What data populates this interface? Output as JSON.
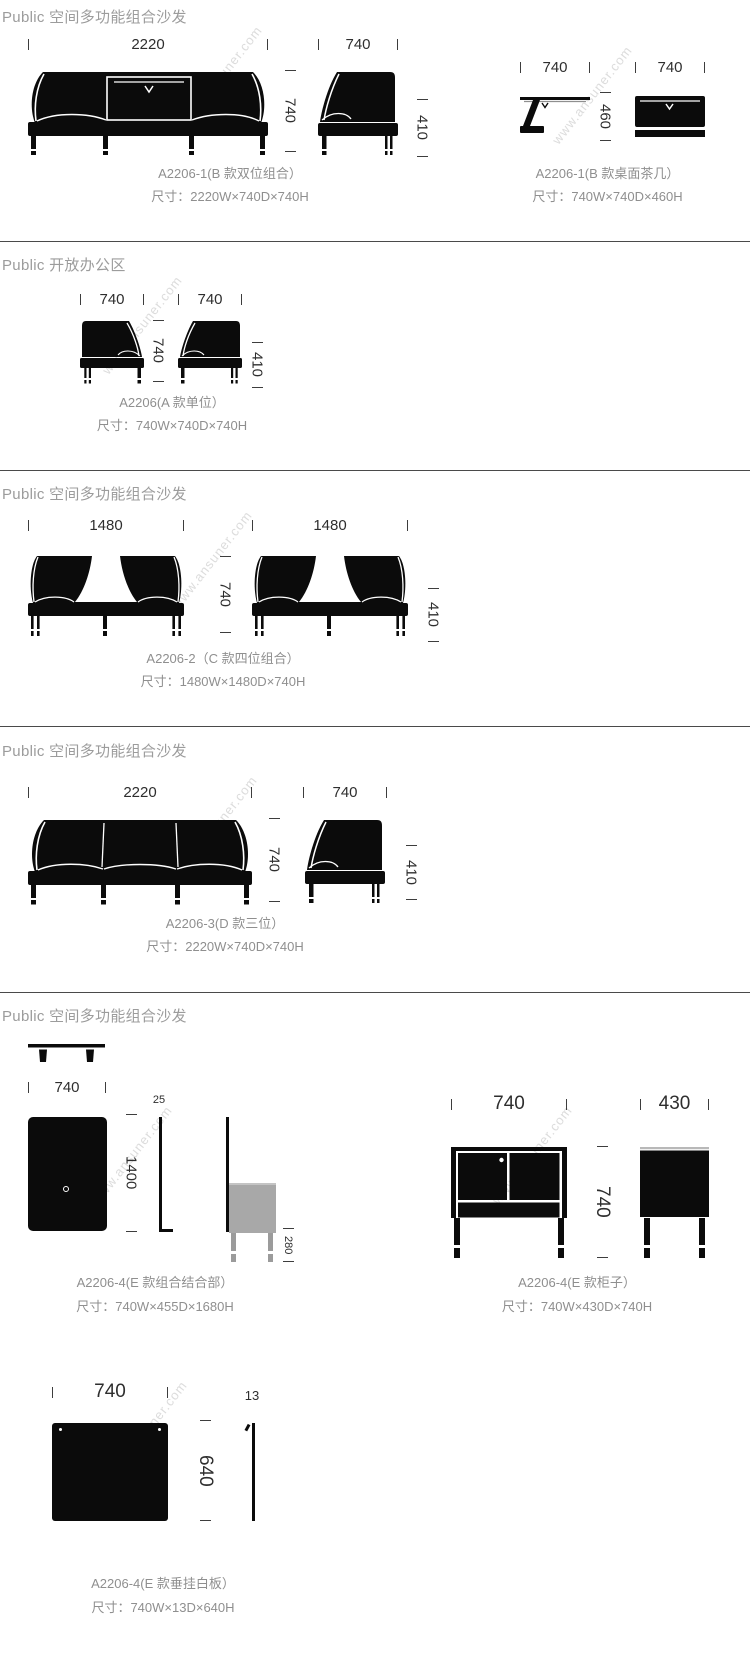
{
  "watermark": "www.ansuner.com",
  "sections": [
    {
      "header": "Public 空间多功能组合沙发",
      "dims": {
        "sofa_width": "2220",
        "sofa_height": "740",
        "side_width": "740",
        "seat_height": "410",
        "table_width": "740",
        "table_height": "460",
        "table_front_width": "740"
      },
      "items": [
        {
          "name": "A2206-1(B 款双位组合）",
          "size": "尺寸：2220W×740D×740H"
        },
        {
          "name": "A2206-1(B 款桌面茶几）",
          "size": "尺寸：740W×740D×460H"
        }
      ]
    },
    {
      "header": "Public 开放办公区",
      "dims": {
        "chair1_width": "740",
        "chair2_width": "740",
        "depth": "740",
        "seat_height": "410"
      },
      "items": [
        {
          "name": "A2206(A 款单位）",
          "size": "尺寸：740W×740D×740H"
        }
      ]
    },
    {
      "header": "Public 空间多功能组合沙发",
      "dims": {
        "left_width": "1480",
        "right_width": "1480",
        "height": "740",
        "seat_height": "410"
      },
      "items": [
        {
          "name": "A2206-2（C 款四位组合）",
          "size": "尺寸：1480W×1480D×740H"
        }
      ]
    },
    {
      "header": "Public 空间多功能组合沙发",
      "dims": {
        "sofa_width": "2220",
        "sofa_height": "740",
        "side_width": "740",
        "seat_height": "410"
      },
      "items": [
        {
          "name": "A2206-3(D 款三位）",
          "size": "尺寸：2220W×740D×740H"
        }
      ]
    },
    {
      "header": "Public 空间多功能组合沙发",
      "dims": {
        "panel_width": "740",
        "panel_height": "1400",
        "panel_thickness": "25",
        "shelf_height": "280",
        "cabinet_width": "740",
        "cabinet_height": "740",
        "cabinet_depth": "430",
        "board_width": "740",
        "board_thickness": "13",
        "board_height": "640"
      },
      "items": [
        {
          "name": "A2206-4(E 款组合结合部）",
          "size": "尺寸：740W×455D×1680H"
        },
        {
          "name": "A2206-4(E 款柜子）",
          "size": "尺寸：740W×430D×740H"
        },
        {
          "name": "A2206-4(E 款垂挂白板）",
          "size": "尺寸：740W×13D×640H"
        }
      ]
    }
  ]
}
